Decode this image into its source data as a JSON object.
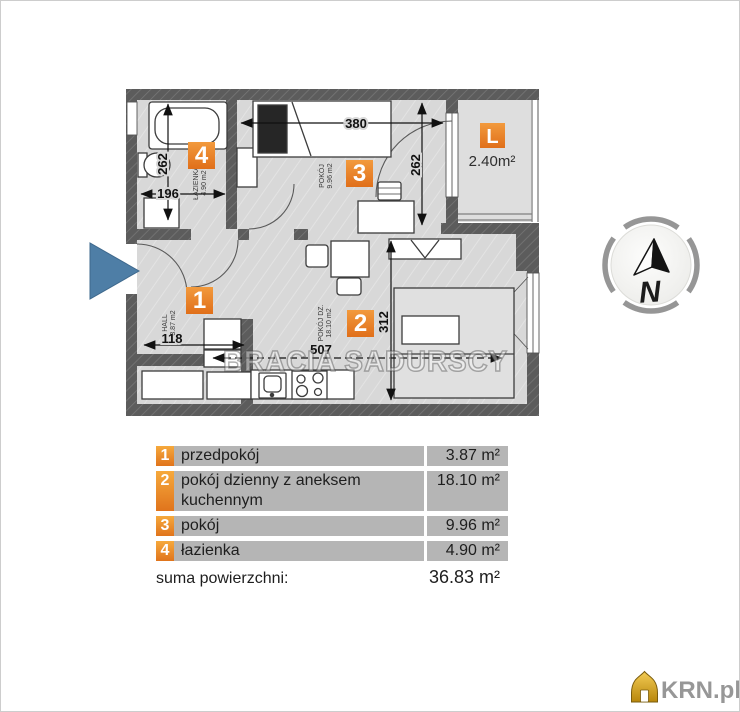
{
  "plan": {
    "watermark": "BRACIA SADURSCY",
    "badge_1": "1",
    "badge_2": "2",
    "badge_3": "3",
    "badge_4": "4",
    "badge_l": "L",
    "balcony_area": "2.40m²",
    "dims": {
      "room3_width": "380",
      "room3_height": "262",
      "bath_height": "262",
      "bath_width": "196",
      "hall_width": "118",
      "room2_width": "507",
      "room2_height": "312"
    },
    "room_labels": {
      "bath": "ŁAZIENKA",
      "bath_area": "4.90 m2",
      "room3": "POKÓJ",
      "room3_area": "9.96 m2",
      "hall": "HALL",
      "hall_area": "3.87 m2",
      "room2": "POKÓJ DZ.",
      "room2_area": "18.10 m2"
    }
  },
  "compass": {
    "north": "N"
  },
  "legend": {
    "rows": [
      {
        "num": "1",
        "name": "przedpokój",
        "area": "3.87 m²"
      },
      {
        "num": "2",
        "name": "pokój dzienny z aneksem kuchennym",
        "area": "18.10 m²"
      },
      {
        "num": "3",
        "name": "pokój",
        "area": "9.96 m²"
      },
      {
        "num": "4",
        "name": "łazienka",
        "area": "4.90 m²"
      }
    ],
    "sum_label": "suma powierzchni:",
    "sum_value": "36.83 m²"
  },
  "branding": {
    "site": "KRN.pl"
  },
  "colors": {
    "accent_orange": "#ed7d31",
    "wall_gray": "#5c5c5c",
    "floor_gray": "#d8d8d8",
    "entrance_blue": "#4e7ea6",
    "table_row_gray": "#b5b5b5",
    "logo_gold": "#d9a21b"
  }
}
